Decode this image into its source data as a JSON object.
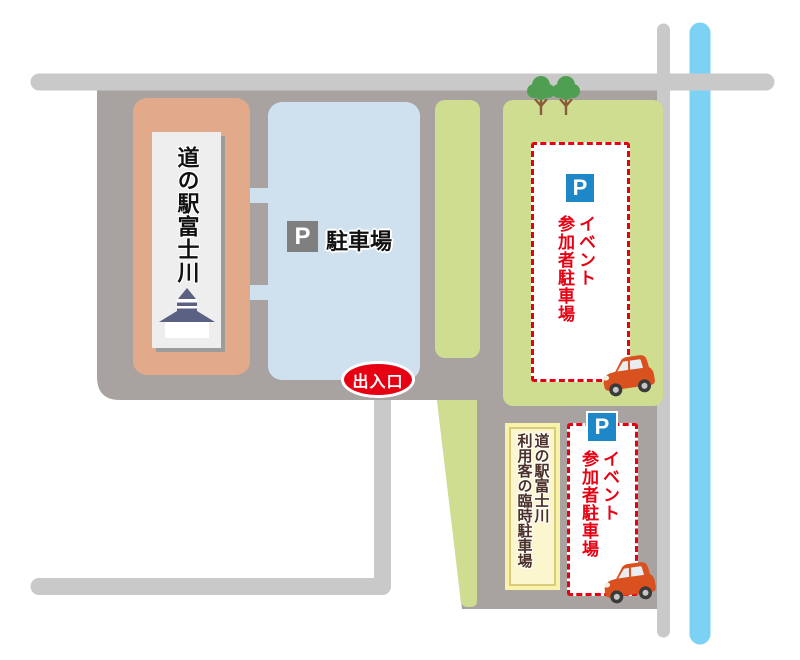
{
  "map": {
    "station_sign": {
      "text": "道の駅富士川"
    },
    "main_parking": {
      "p_symbol": "P",
      "label": "駐車場"
    },
    "entrance_badge": {
      "label": "出入口"
    },
    "event_parking_top": {
      "p_symbol": "P",
      "lines": [
        "イベント",
        "参加者駐車場"
      ]
    },
    "event_parking_bottom": {
      "p_symbol": "P",
      "lines": [
        "イベント",
        "参加者駐車場"
      ]
    },
    "temporary_parking": {
      "lines": [
        "道の駅富士川",
        "利用客の臨時駐車場"
      ]
    }
  },
  "colors": {
    "road_gray": "#c9c9c9",
    "lot_gray": "#a8a2a0",
    "station_block_salmon": "#e2aa8b",
    "parking_blue": "#cfe1ee",
    "green_area": "#cedd8f",
    "river_blue": "#7cd2f5",
    "accent_red": "#e60012",
    "p_sign_blue": "#1e87c7",
    "p_sign_gray": "#7f7f7f",
    "temp_parking_yellow": "#f9f2aa",
    "temp_parking_text_brown": "#4a3027",
    "sign_roof_navy": "#5b6183",
    "tree_green": "#4f9e52",
    "car_orange": "#d8511f"
  }
}
